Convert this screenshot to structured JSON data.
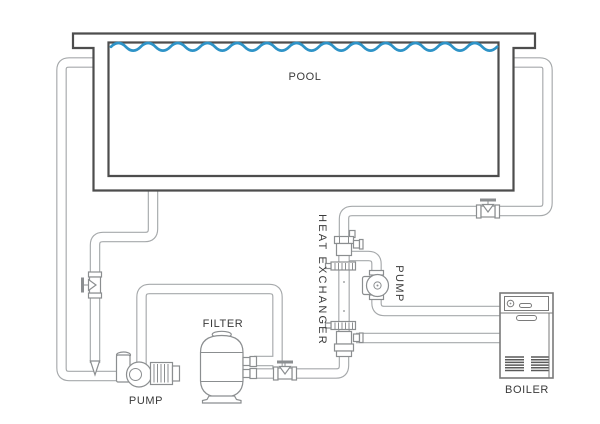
{
  "diagram": {
    "labels": {
      "pool": "POOL",
      "filter": "FILTER",
      "pump_main": "PUMP",
      "heat_exchanger": "HEAT EXCHANGER",
      "pump_circulation": "PUMP",
      "boiler": "BOILER"
    }
  },
  "colors": {
    "background": "#FFFFFF",
    "water": "#2E93C7",
    "pipe": "#A6A9AB",
    "component": "#8B8E90",
    "pool_outline": "#4D4D4D",
    "boiler_outline": "#7A7A7A",
    "grille": "#5A5A5A",
    "label_text": "#3A3A3A"
  }
}
